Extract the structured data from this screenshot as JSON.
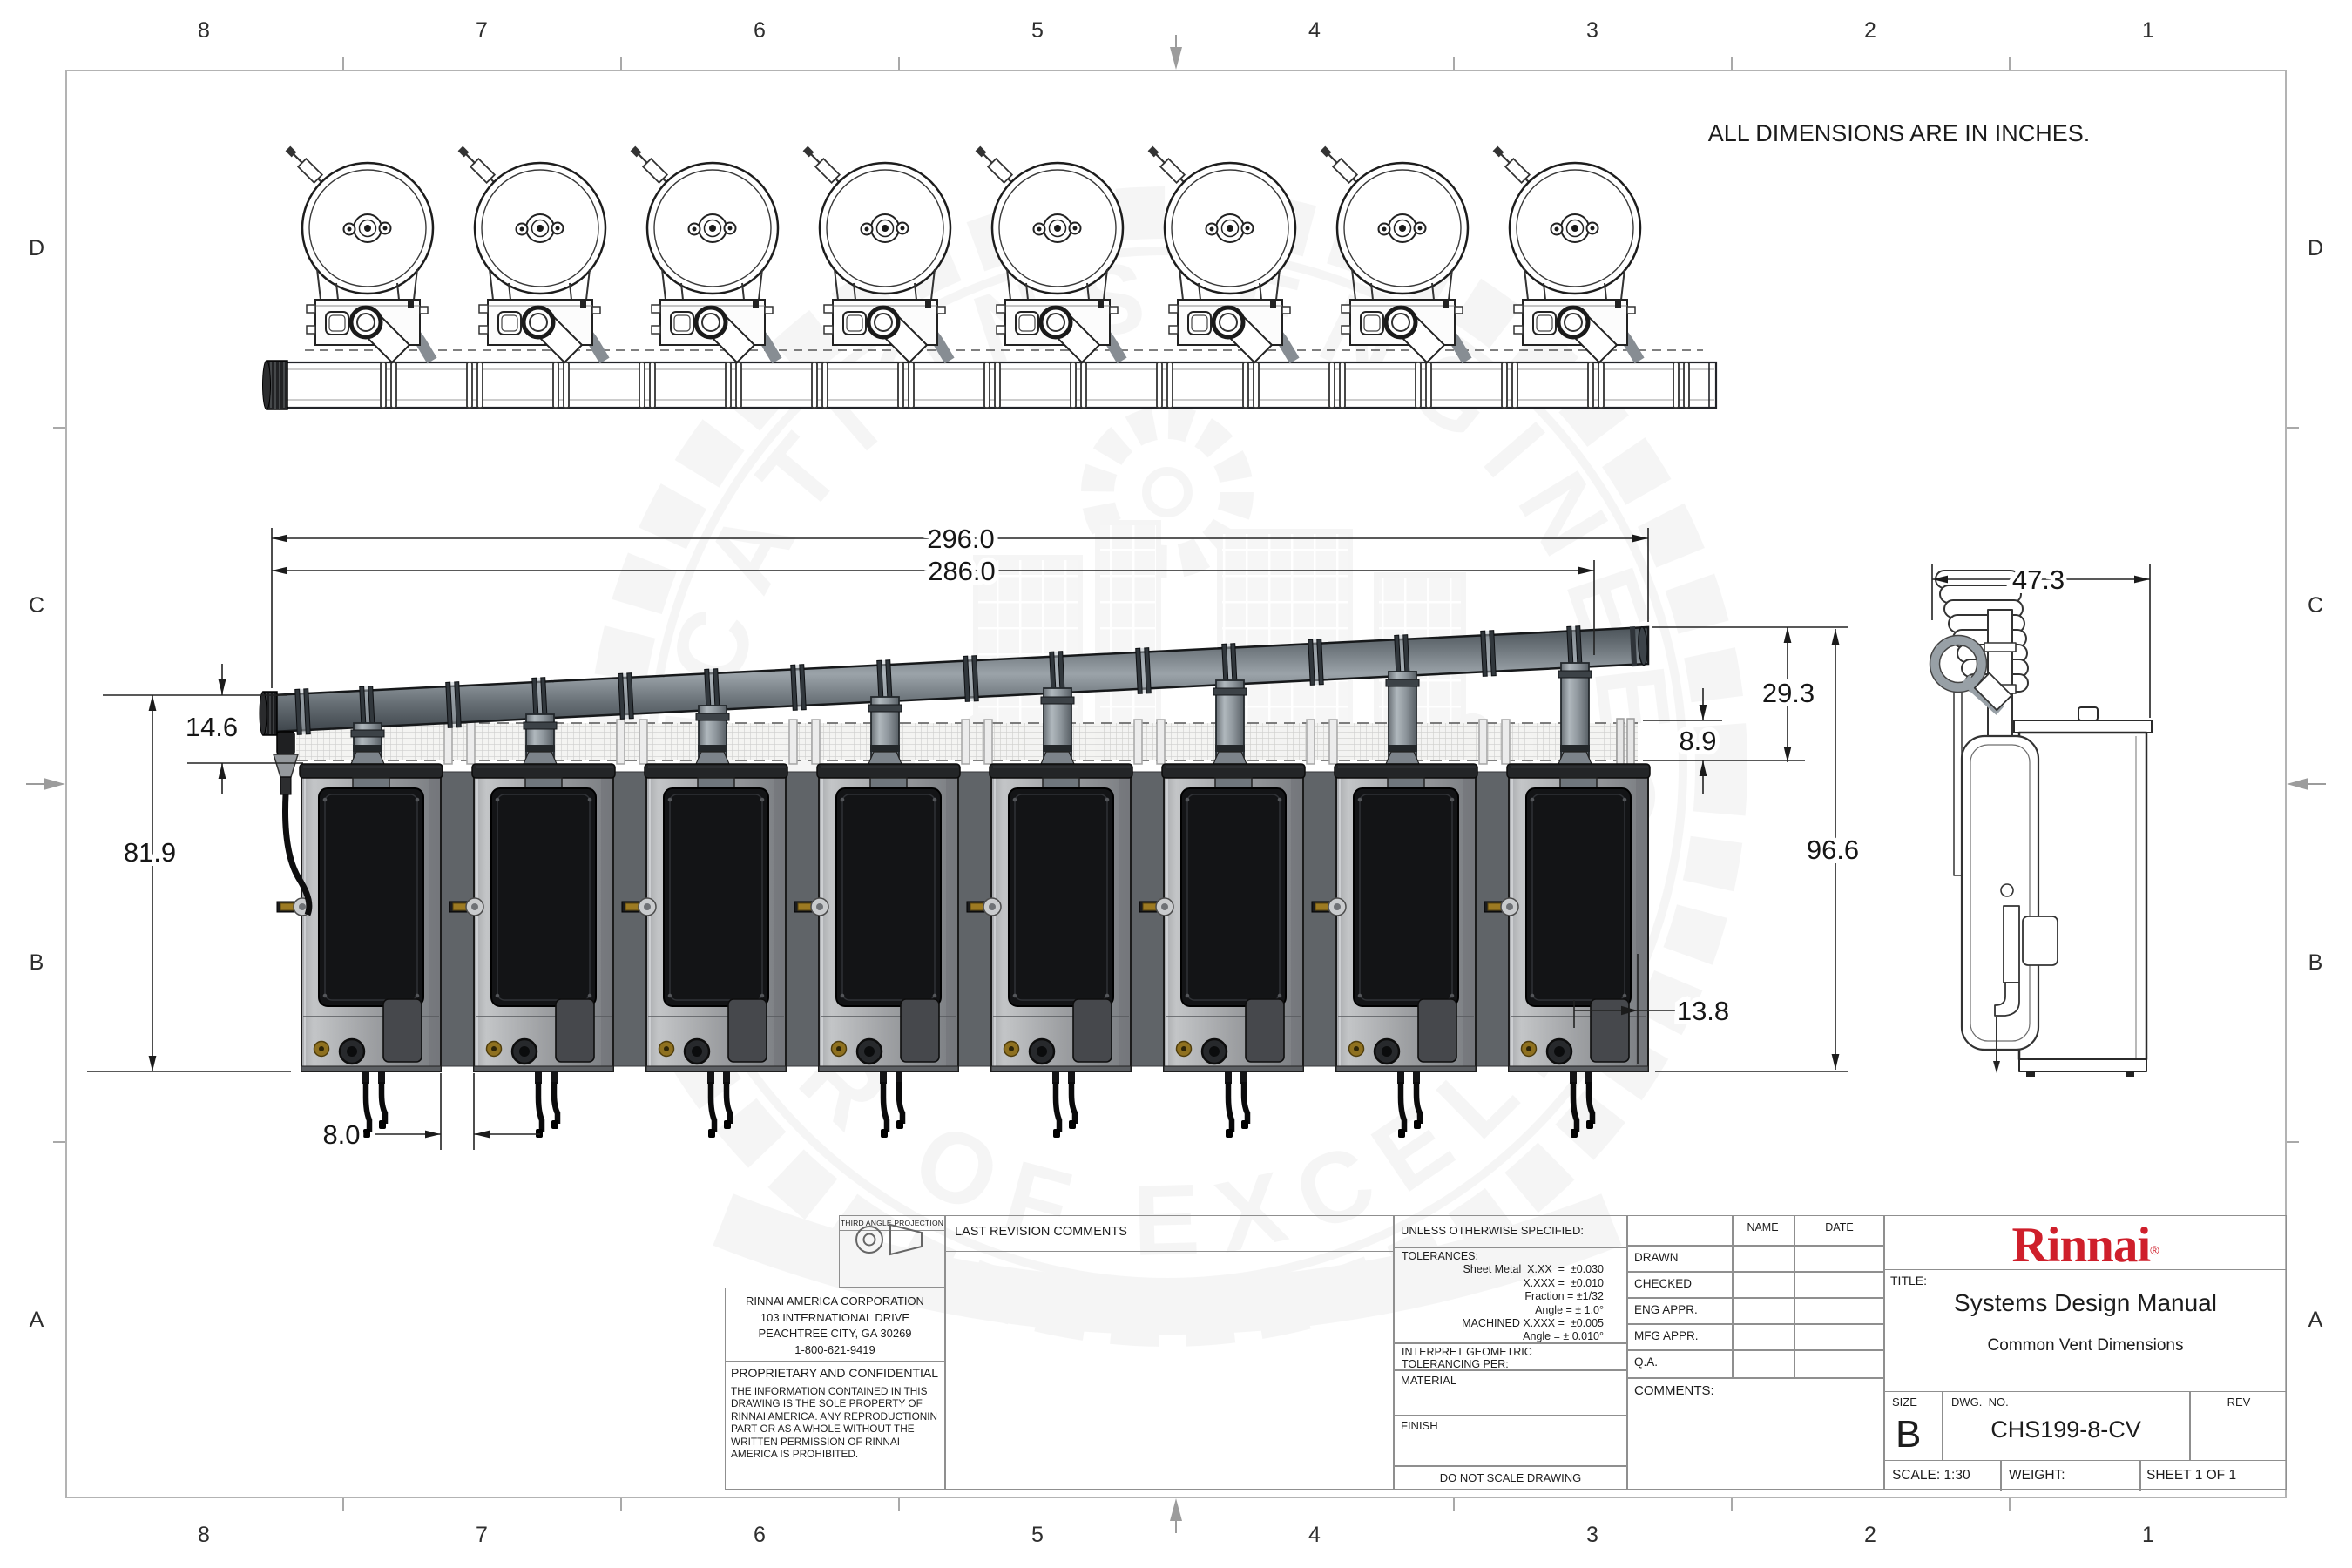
{
  "sheet": {
    "units_note": "ALL DIMENSIONS ARE IN INCHES."
  },
  "zones": {
    "columns": [
      "8",
      "7",
      "6",
      "5",
      "4",
      "3",
      "2",
      "1"
    ],
    "rows": [
      "D",
      "C",
      "B",
      "A"
    ]
  },
  "dimensions": {
    "overall_vent_length": "296.0",
    "vent_length_to_last_tee": "286.0",
    "termination_to_heater_top": "14.6",
    "heater_height": "81.9",
    "heater_spacing": "8.0",
    "intake_duct_height": "8.9",
    "vent_top_to_duct": "29.3",
    "overall_height": "96.6",
    "panel_offset": "13.8",
    "side_depth": "47.3"
  },
  "title_block": {
    "projection_label": "THIRD ANGLE PROJECTION",
    "revision_header": "LAST REVISION COMMENTS",
    "company_lines": [
      "RINNAI AMERICA CORPORATION",
      "103 INTERNATIONAL DRIVE",
      "PEACHTREE CITY, GA  30269",
      "1-800-621-9419"
    ],
    "confidential_title": "PROPRIETARY AND CONFIDENTIAL",
    "confidential_body": "THE INFORMATION CONTAINED IN THIS DRAWING IS THE SOLE PROPERTY OF RINNAI AMERICA. ANY REPRODUCTIONIN PART OR AS A WHOLE WITHOUT THE WRITTEN PERMISSION OF RINNAI AMERICA IS PROHIBITED.",
    "spec_header": "UNLESS OTHERWISE SPECIFIED:",
    "tolerances": [
      "TOLERANCES:",
      "Sheet Metal  X.XX  =  ±0.030",
      "X.XXX =  ±0.010",
      "Fraction = ±1/32",
      "Angle = ± 1.0°",
      "MACHINED X.XXX =  ±0.005",
      "Angle = ± 0.010°"
    ],
    "interpret_line1": "INTERPRET GEOMETRIC",
    "interpret_line2": "TOLERANCING PER:",
    "material_label": "MATERIAL",
    "finish_label": "FINISH",
    "do_not_scale": "DO NOT SCALE DRAWING",
    "approvals": {
      "name_header": "NAME",
      "date_header": "DATE",
      "rows": [
        "DRAWN",
        "CHECKED",
        "ENG APPR.",
        "MFG APPR.",
        "Q.A."
      ],
      "comments_label": "COMMENTS:"
    },
    "brand": "Rinnai",
    "reg_mark": "®",
    "title_label": "TITLE:",
    "title_line1": "Systems Design Manual",
    "title_line2": "Common Vent Dimensions",
    "size_label": "SIZE",
    "size_value": "B",
    "dwg_label": "DWG.  NO.",
    "dwg_value": "CHS199-8-CV",
    "rev_label": "REV",
    "scale_text": "SCALE: 1:30",
    "weight_text": "WEIGHT:",
    "sheet_text": "SHEET 1 OF 1"
  },
  "watermark": {
    "arc_top": "APPLICATIONS ENGINEERING",
    "arc_bottom": "CENTER OF EXCELLENCE",
    "brand": "Rinnai",
    "reg": "®"
  },
  "colors": {
    "brand_red": "#cf1f2b",
    "pipe_gray": "#6b7378",
    "panel_black": "#141517"
  }
}
